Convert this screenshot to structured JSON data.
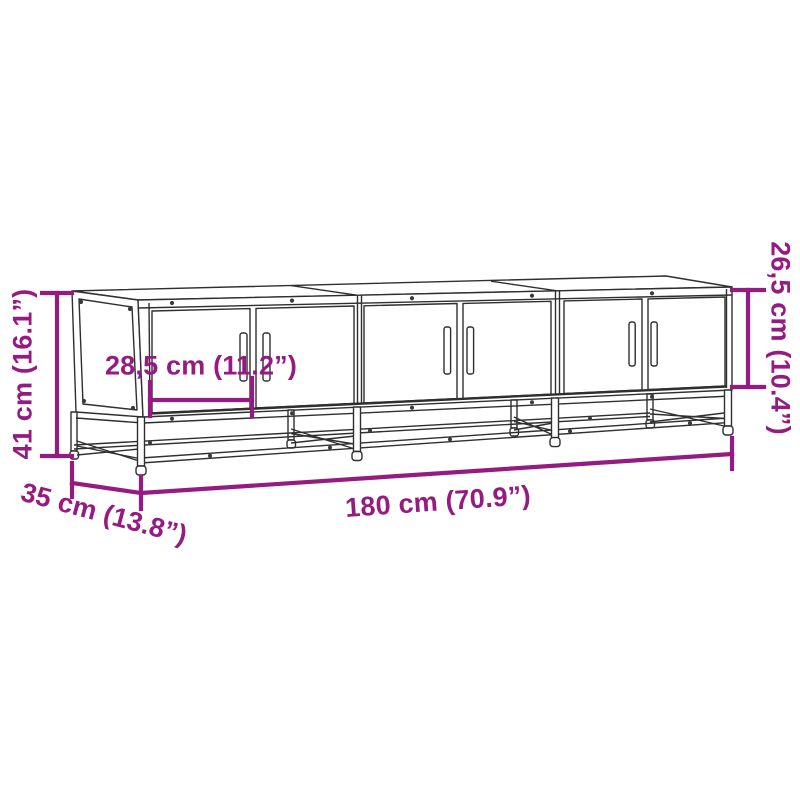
{
  "diagram": {
    "kind": "furniture-dimension-line-drawing",
    "dimensions": {
      "overall_height": {
        "label": "41 cm (16.1”)",
        "cm": "41",
        "inches": "16.1"
      },
      "overall_width": {
        "label": "180 cm (70.9”)",
        "cm": "180",
        "inches": "70.9"
      },
      "overall_depth": {
        "label": "35 cm (13.8”)",
        "cm": "35",
        "inches": "13.8"
      },
      "door_width": {
        "label": "28,5 cm (11.2”)",
        "cm": "28,5",
        "inches": "11.2"
      },
      "door_height": {
        "label": "26,5 cm (10.4”)",
        "cm": "26,5",
        "inches": "10.4"
      }
    }
  },
  "colors": {
    "dimension_accent": "#951b81",
    "drawing_line": "#2f2f2f",
    "background": "#ffffff"
  }
}
